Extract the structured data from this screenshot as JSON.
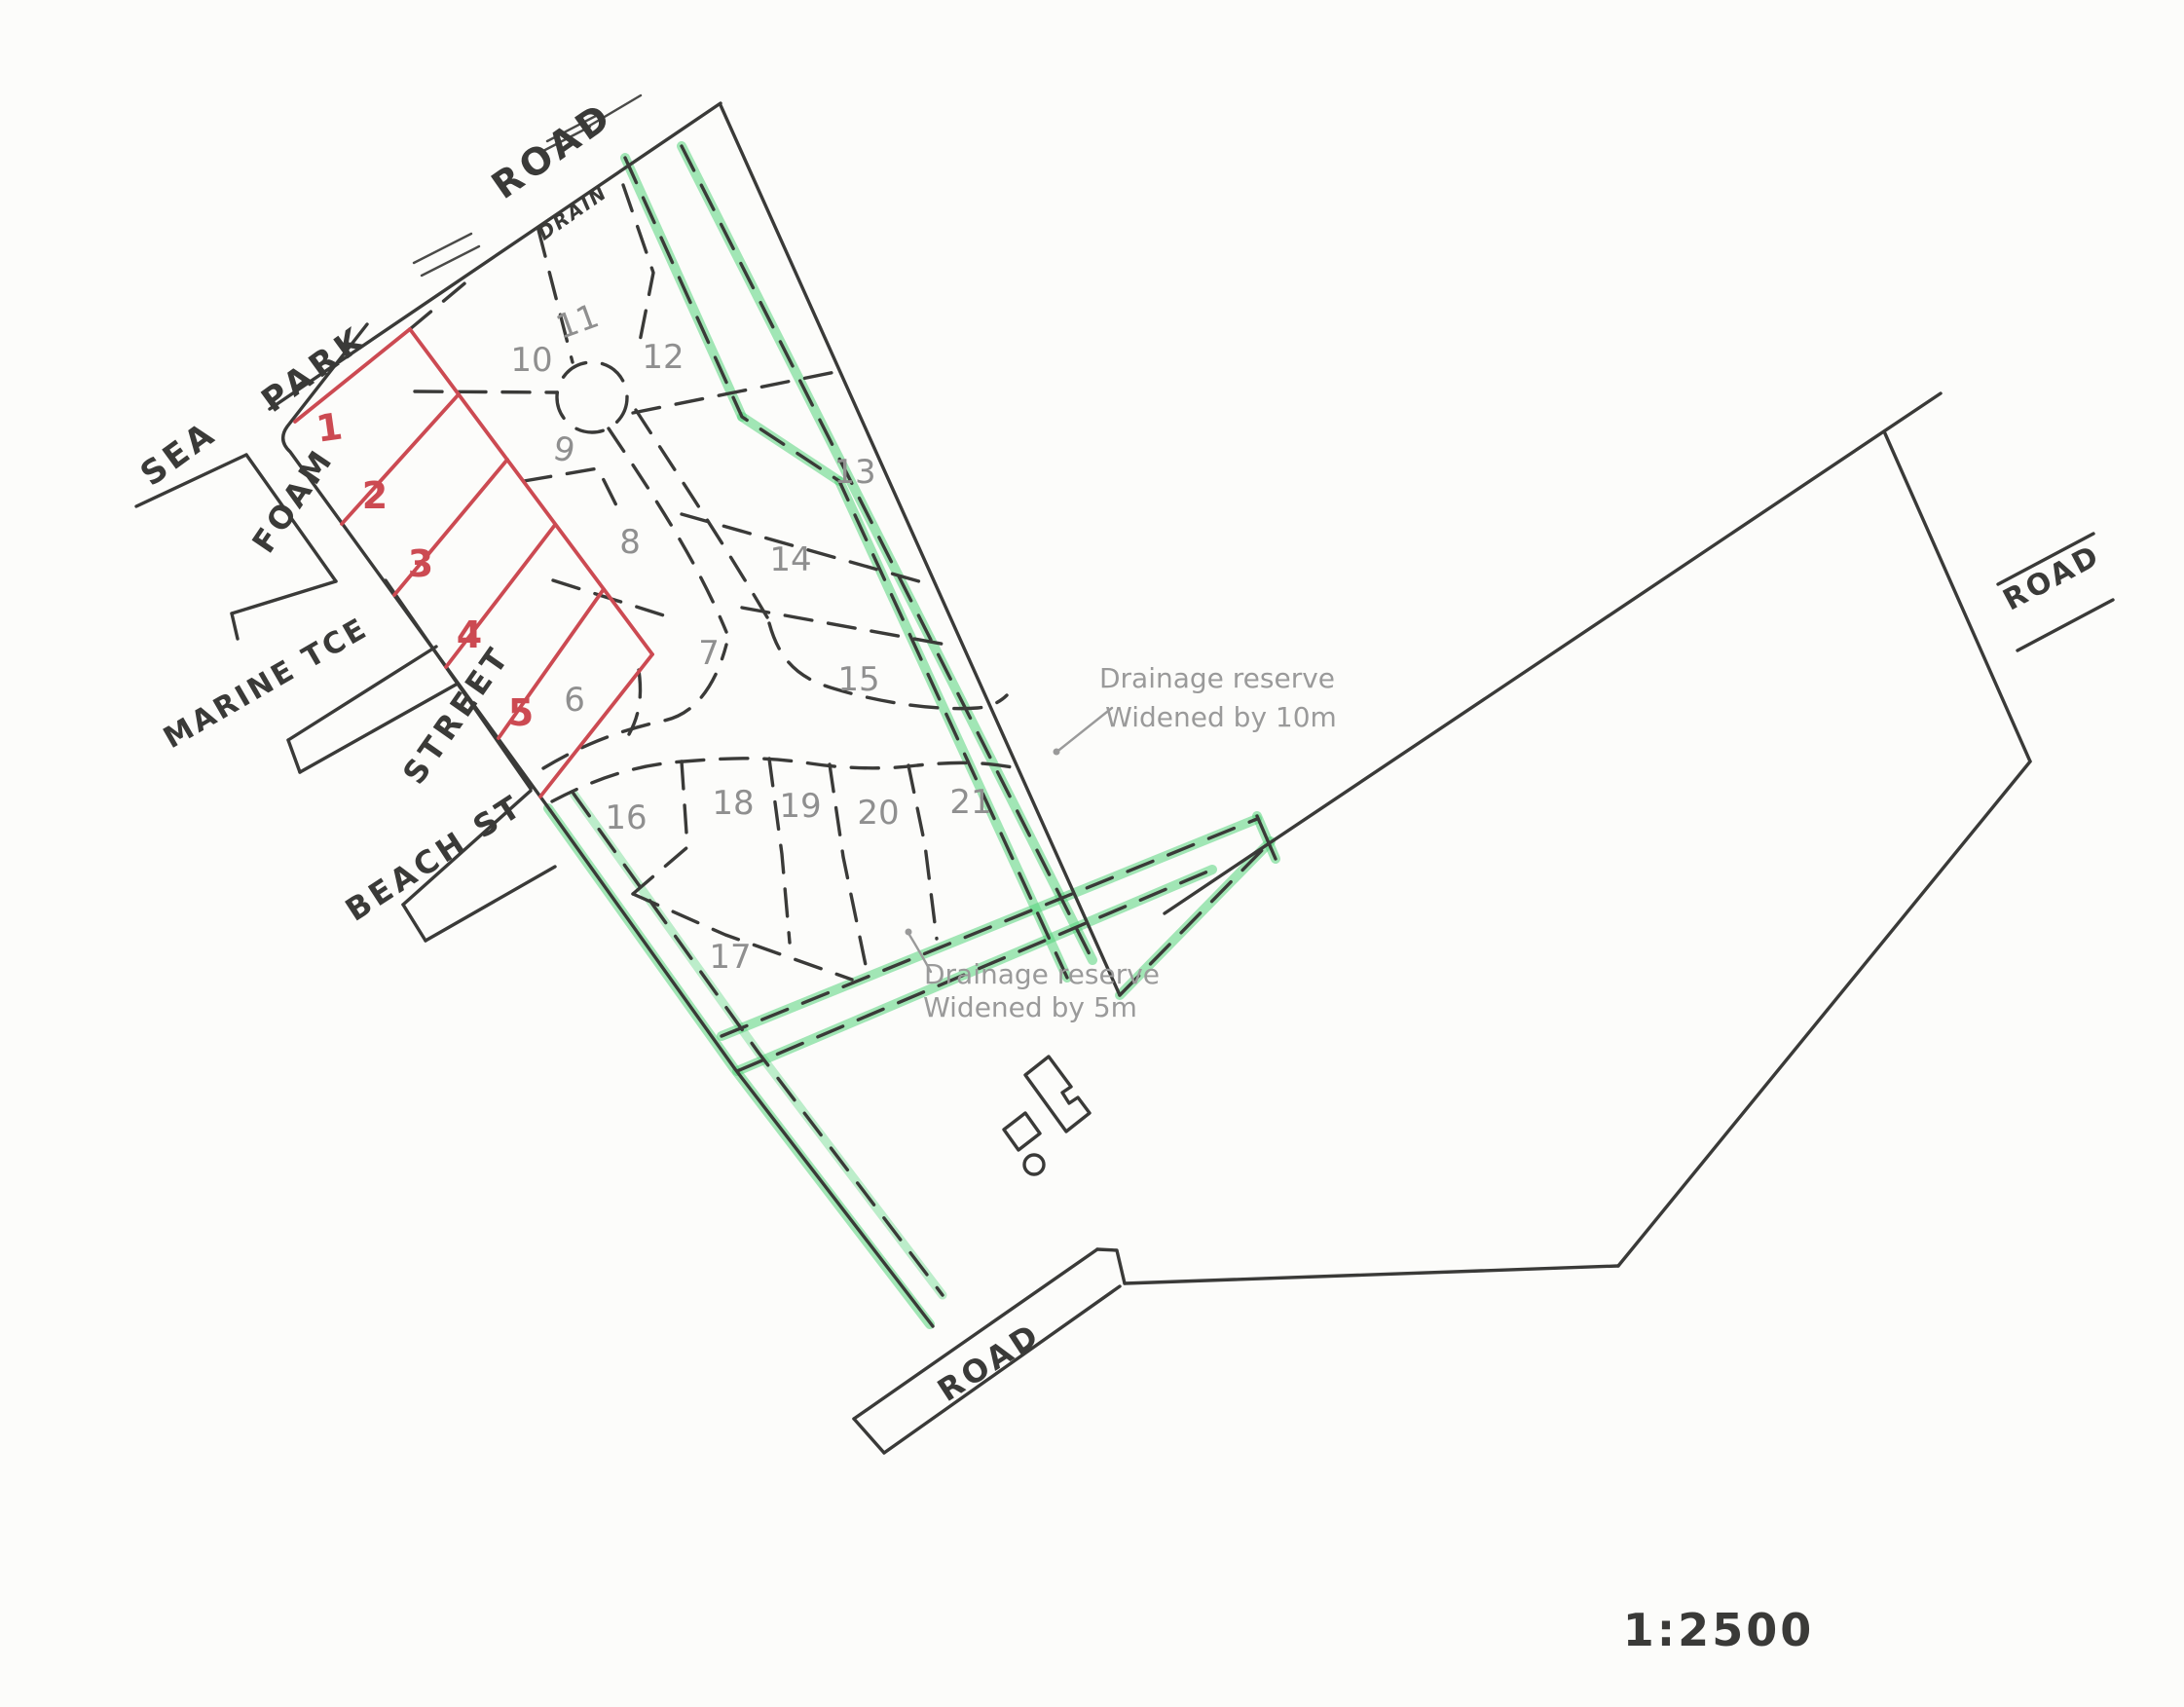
{
  "scale": {
    "label": "1:2500"
  },
  "roads": {
    "top": "ROAD",
    "top_drain": "DRAIN",
    "right": "ROAD",
    "bottom": "ROAD"
  },
  "streets": {
    "sea": "SEA",
    "park": "PARK",
    "foam": "FOAM",
    "marine_tce": "MARINE TCE",
    "street": "STREET",
    "beach_st": "BEACH ST"
  },
  "lots": {
    "red": [
      "1",
      "2",
      "3",
      "4",
      "5"
    ],
    "gray": [
      "6",
      "7",
      "8",
      "9",
      "10",
      "11",
      "12",
      "13",
      "14",
      "15",
      "16",
      "17",
      "18",
      "19",
      "20",
      "21"
    ]
  },
  "annotations": {
    "reserve10": {
      "line1": "Drainage reserve",
      "line2": "Widened by 10m"
    },
    "reserve5": {
      "line1": "Drainage reserve",
      "line2": "Widened by 5m"
    }
  },
  "colors": {
    "paper": "#fcfcfa",
    "ink": "#3a3a38",
    "pencil": "#8f8f8f",
    "red_highlight": "#cc4a52",
    "green_highlight": "#55d47c"
  }
}
